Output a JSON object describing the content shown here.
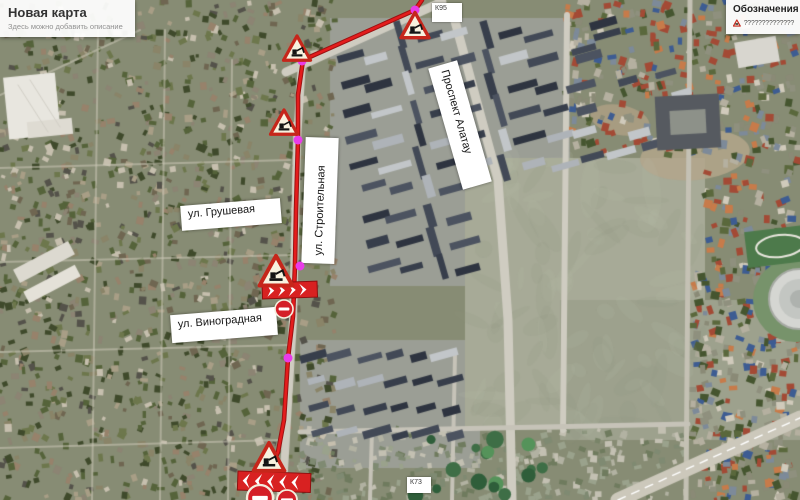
{
  "title_card": {
    "title": "Новая карта",
    "subtitle": "Здесь можно добавить описание"
  },
  "legend": {
    "title": "Обозначения",
    "items": [
      {
        "icon": "roadwork-icon",
        "label": "??????????????"
      }
    ]
  },
  "street_labels": [
    {
      "id": "grushevaya",
      "text": "ул. Грушевая"
    },
    {
      "id": "vinogradnaya",
      "text": "ул. Виноградная"
    },
    {
      "id": "stroitelnaya",
      "text": "ул. Строительная"
    },
    {
      "id": "alatau",
      "text": "Проспект Алатау"
    }
  ],
  "marker_labels": [
    {
      "text": "К95"
    },
    {
      "text": "К73"
    }
  ],
  "map_annotations": {
    "route": {
      "color": "#e41c1c",
      "casing_color": "#9c1212",
      "points": [
        [
          422,
          0
        ],
        [
          415,
          10
        ],
        [
          303,
          60
        ],
        [
          298,
          95
        ],
        [
          298,
          140
        ],
        [
          296,
          210
        ],
        [
          295,
          265
        ],
        [
          293,
          316
        ],
        [
          288,
          358
        ],
        [
          284,
          420
        ],
        [
          278,
          452
        ],
        [
          268,
          474
        ],
        [
          263,
          486
        ]
      ]
    },
    "waypoints": {
      "color": "#e93ce9",
      "points": [
        [
          415,
          10
        ],
        [
          302,
          61
        ],
        [
          298,
          140
        ],
        [
          300,
          266
        ],
        [
          288,
          358
        ]
      ]
    },
    "roadwork_signs": [
      {
        "x": 415,
        "y": 27,
        "size": 28
      },
      {
        "x": 297,
        "y": 50,
        "size": 27
      },
      {
        "x": 284,
        "y": 124,
        "size": 27
      },
      {
        "x": 276,
        "y": 273,
        "size": 33
      },
      {
        "x": 269,
        "y": 459,
        "size": 31
      }
    ],
    "arrow_boards": [
      {
        "x": 262,
        "y": 283,
        "width": 55,
        "height": 16,
        "direction": "right",
        "rotation": -2
      },
      {
        "x": 238,
        "y": 471,
        "width": 73,
        "height": 19,
        "direction": "left",
        "rotation": 2
      }
    ],
    "no_entry_signs": [
      {
        "x": 284,
        "y": 309,
        "radius": 9
      },
      {
        "x": 260,
        "y": 498,
        "radius": 13
      },
      {
        "x": 287,
        "y": 500,
        "radius": 10
      }
    ]
  }
}
